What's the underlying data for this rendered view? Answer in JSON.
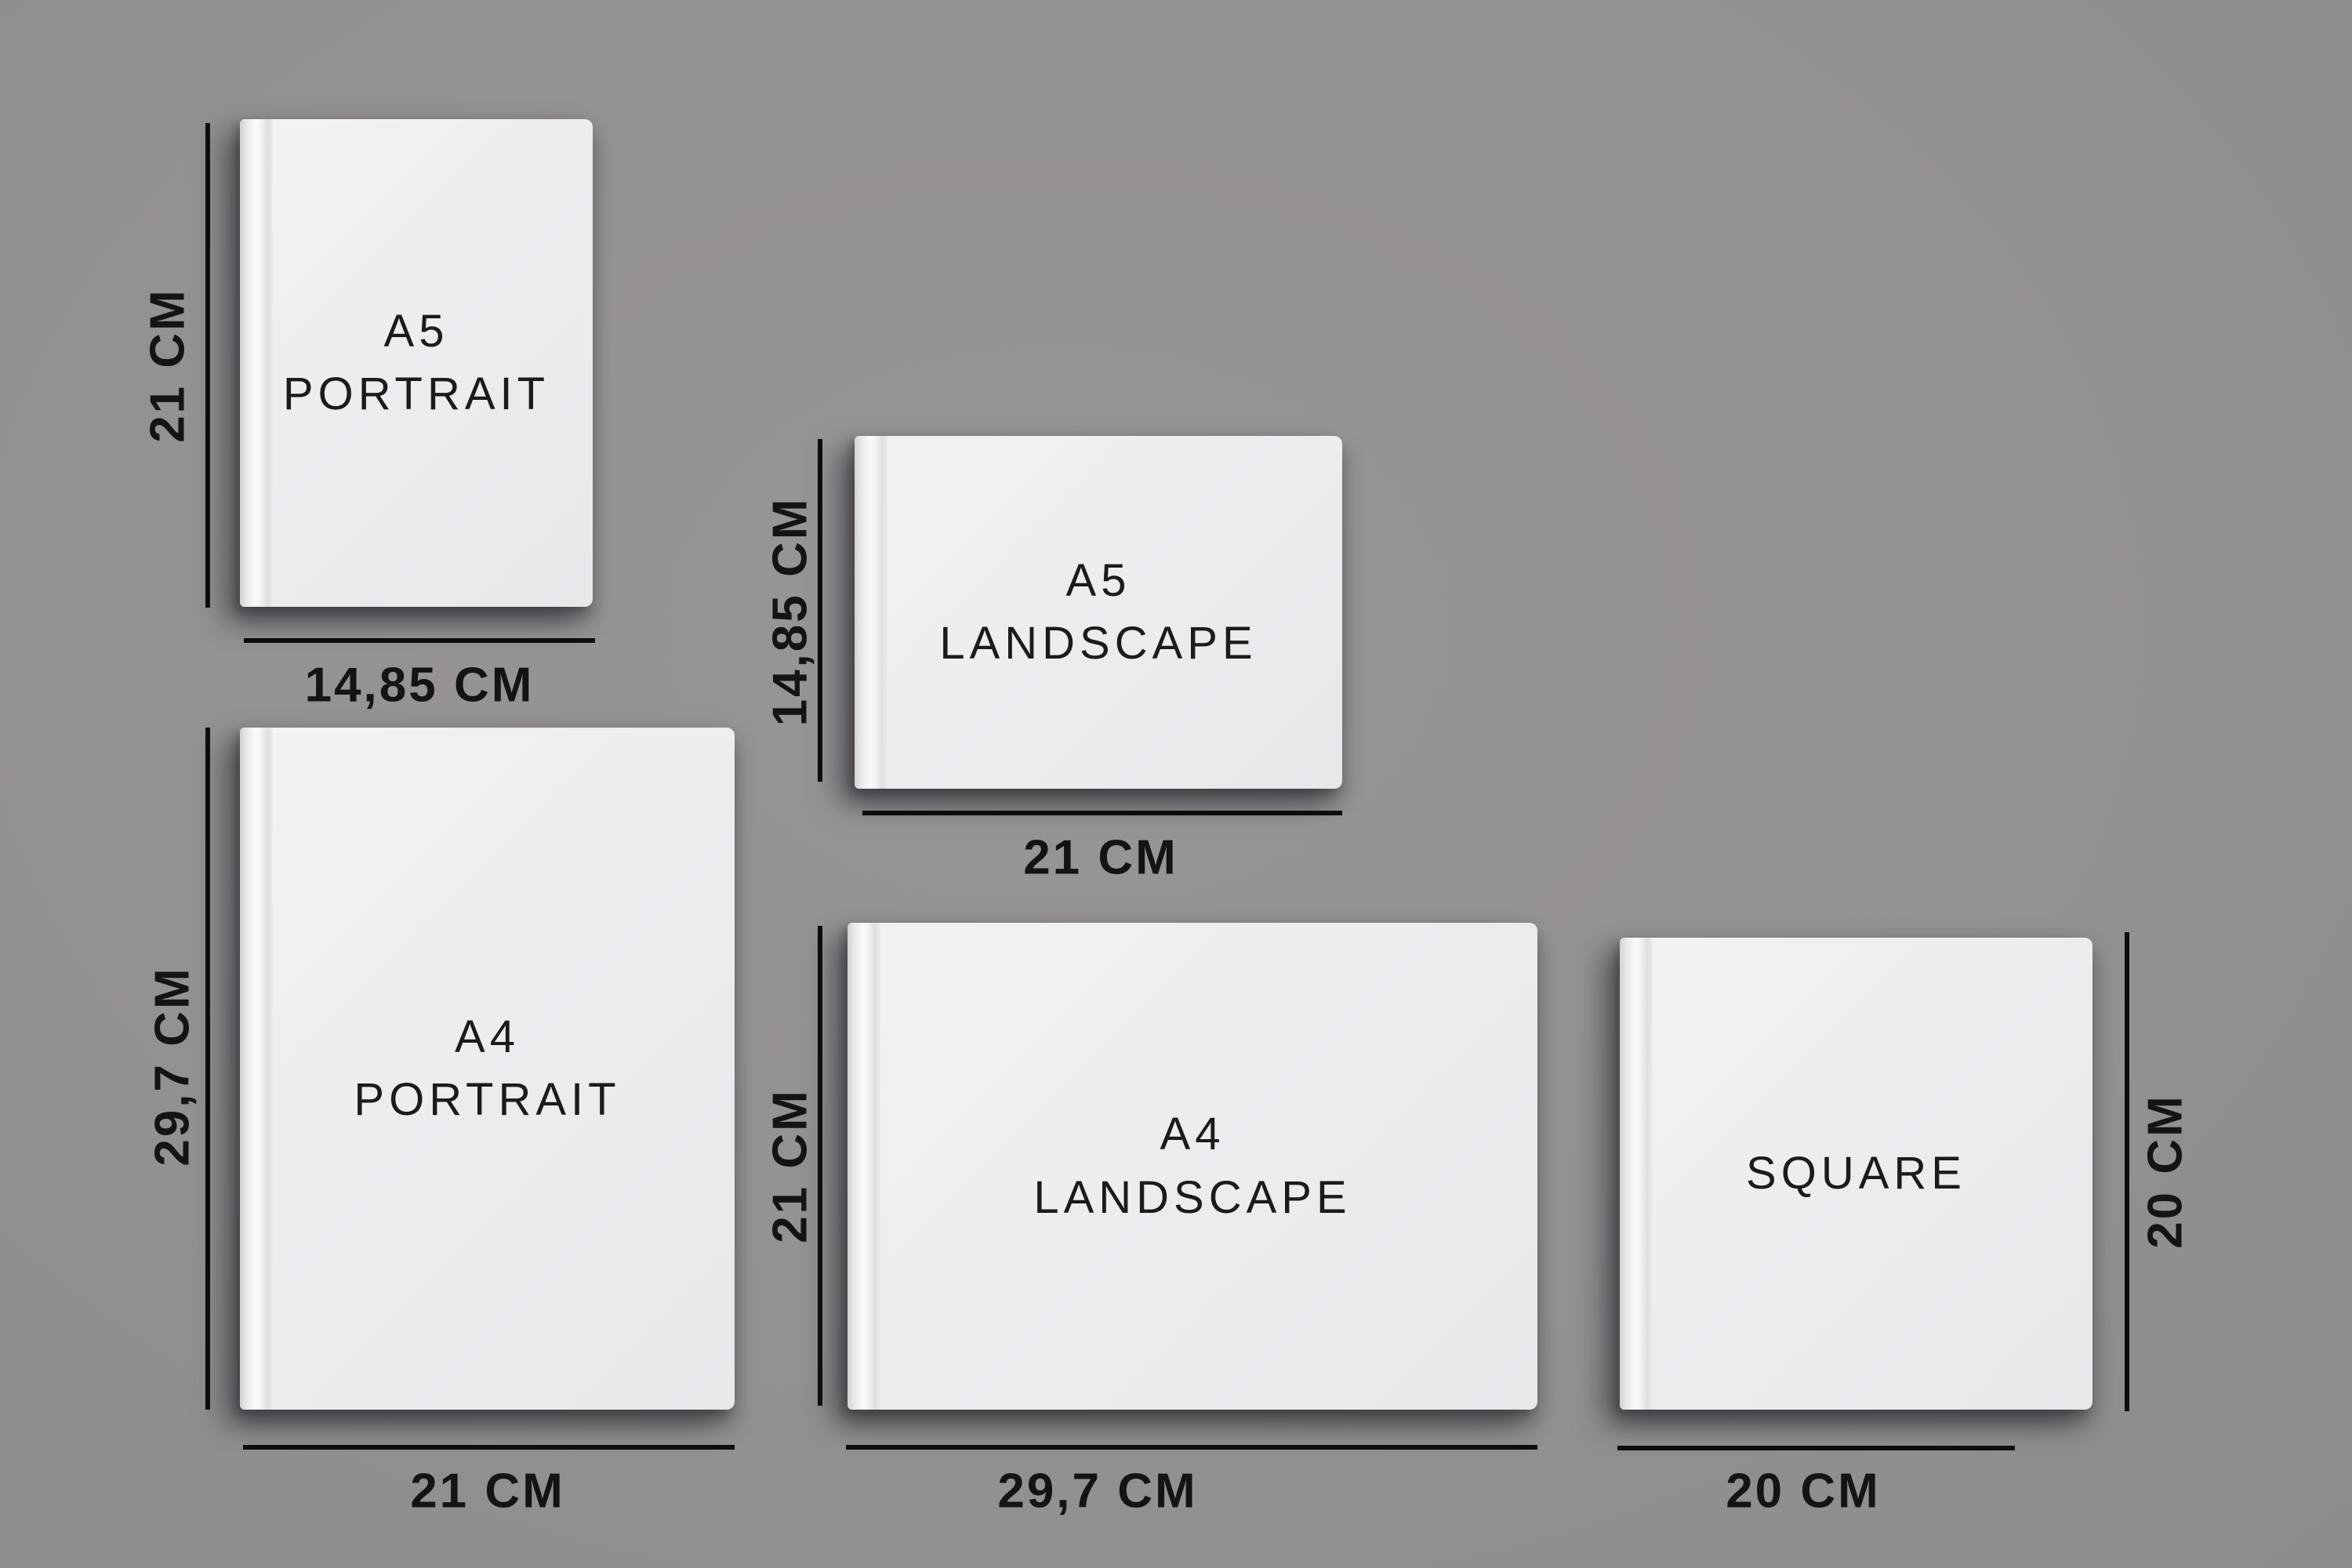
{
  "diagram_title": "Photo book size comparison",
  "colors": {
    "background": "#949194",
    "book_face": "#ededf0",
    "dimension_line": "#0d0d0e",
    "text": "#141415"
  },
  "books": [
    {
      "id": "a5-portrait",
      "orientation": "portrait",
      "title_line1": "A5",
      "title_line2": "PORTRAIT",
      "height_label": "21 CM",
      "width_label": "14,85 CM"
    },
    {
      "id": "a5-landscape",
      "orientation": "landscape",
      "title_line1": "A5",
      "title_line2": "LANDSCAPE",
      "height_label": "14,85 CM",
      "width_label": "21 CM"
    },
    {
      "id": "a4-portrait",
      "orientation": "portrait",
      "title_line1": "A4",
      "title_line2": "PORTRAIT",
      "height_label": "29,7 CM",
      "width_label": "21 CM"
    },
    {
      "id": "a4-landscape",
      "orientation": "landscape",
      "title_line1": "A4",
      "title_line2": "LANDSCAPE",
      "height_label": "21 CM",
      "width_label": "29,7 CM"
    },
    {
      "id": "square",
      "orientation": "square",
      "title_line1": "SQUARE",
      "title_line2": "",
      "height_label": "20 CM",
      "width_label": "20 CM"
    }
  ]
}
